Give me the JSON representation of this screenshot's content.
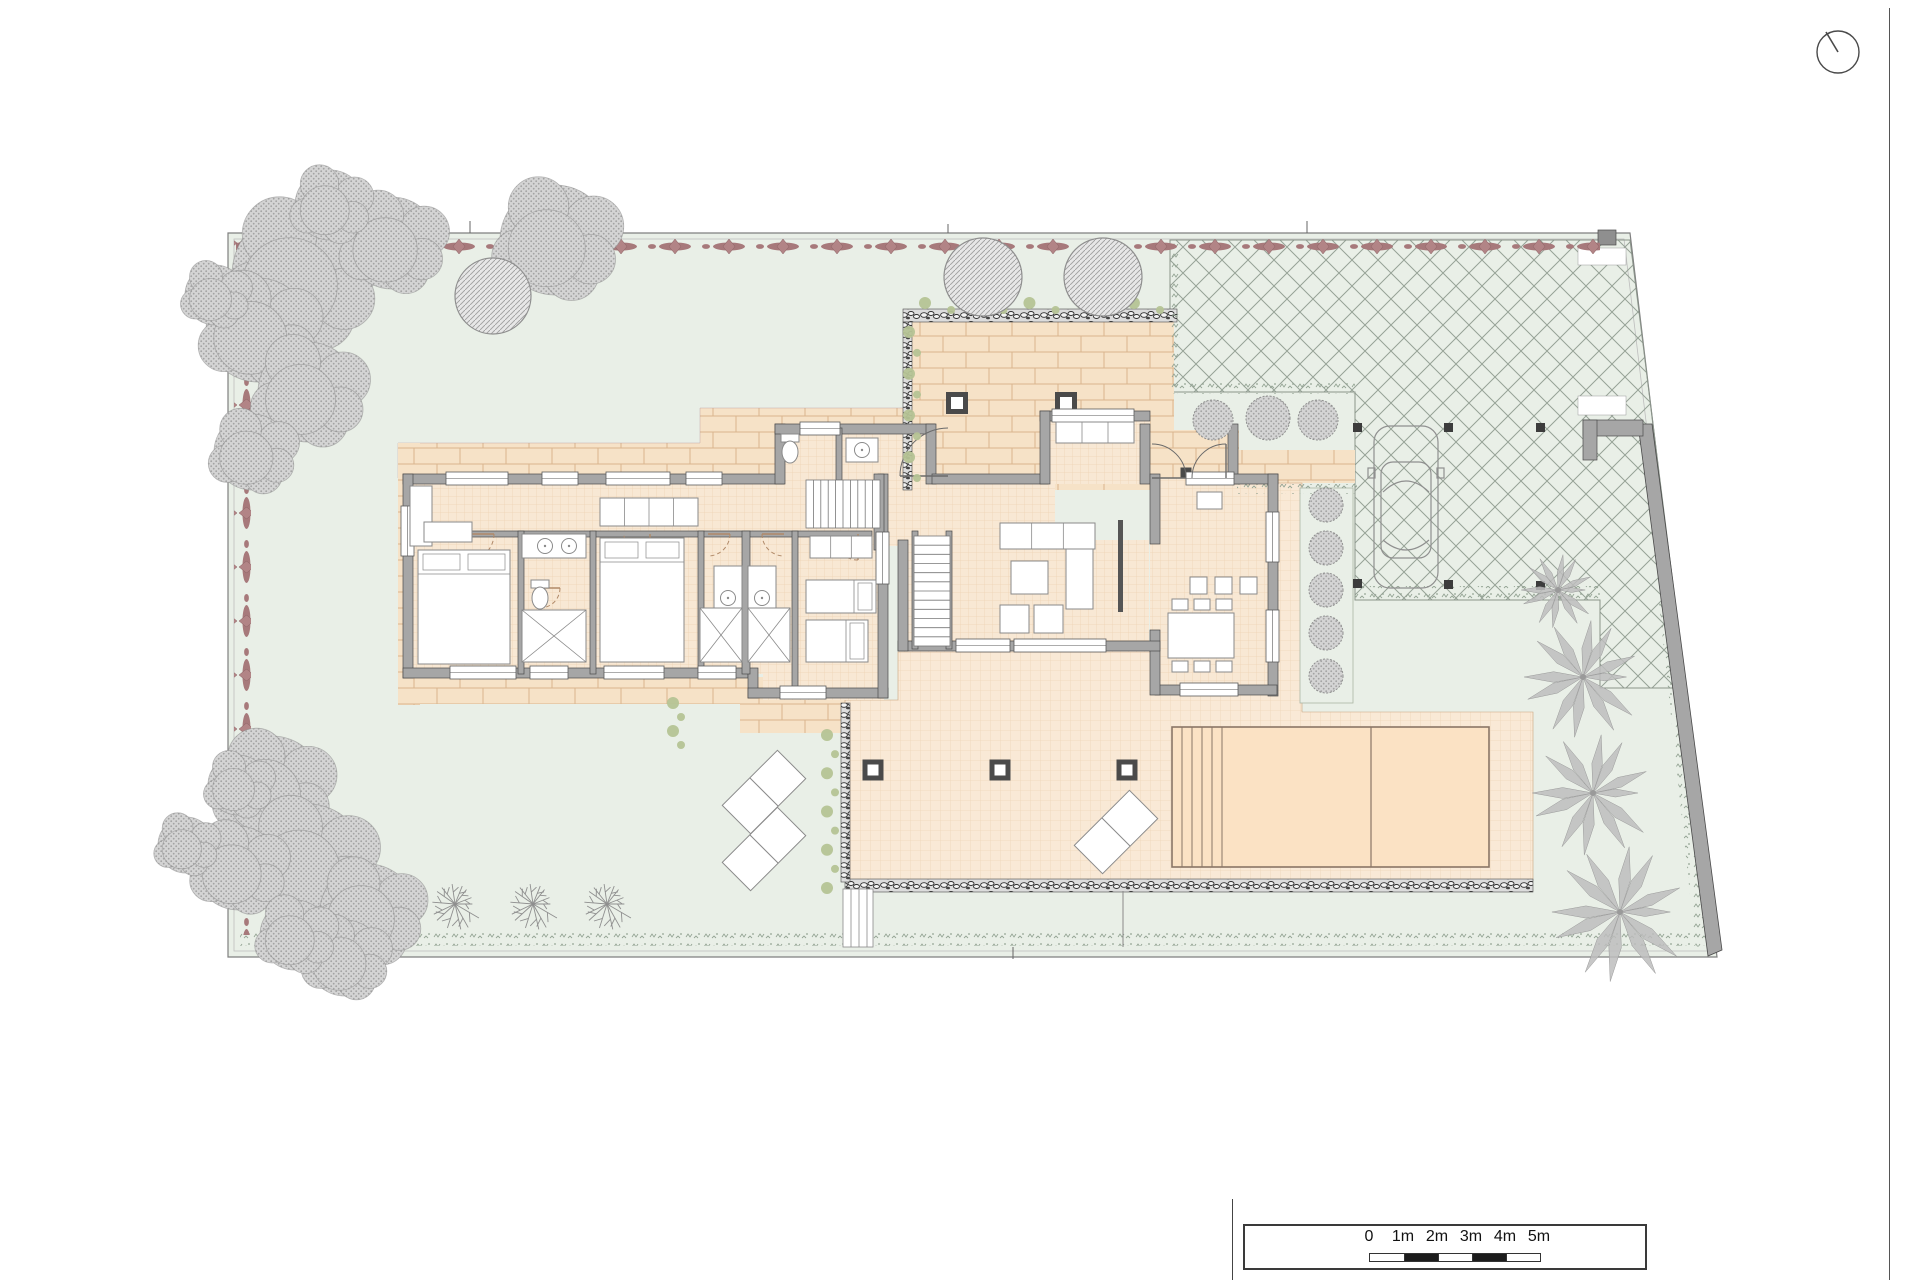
{
  "page": {
    "width": 1920,
    "height": 1280,
    "bg": "#ffffff"
  },
  "colors": {
    "garden": "#e9efe7",
    "lot_line": "#7f7f7f",
    "lot_inner": "#bdbdbd",
    "hedge_fill": "#a7797b",
    "hedge_fill2": "#b28486",
    "hedge_stroke": "#8a6163",
    "canopy_bg": "#d4d4d4",
    "canopy_dot": "#a3a3a3",
    "tree_stroke": "#8f8f8f",
    "cross_line": "#96a296",
    "brick_bg": "#f6e2c7",
    "brick_line": "#d9b48e",
    "tile_bg": "#f8e8d4",
    "tile_line": "#d9a977",
    "terrace_bg": "#f9e9d6",
    "pool_fill": "#fbe2c4",
    "pool_line": "#8a7666",
    "wall": "#a6a6a6",
    "wall_dark": "#4a4a4a",
    "window": "#ffffff",
    "speckle": "#93a393",
    "rubble_bg": "#dcdcdc",
    "rubble_stone": "#2f2f2f",
    "olive": "#b5c395",
    "furn_stroke": "#8a8a8a",
    "door": "#6a6a6a",
    "door_dash": "#b08968",
    "slant_wall": "#a6a6a6",
    "post_dark": "#3c3c3c"
  },
  "scale_bar": {
    "labels": [
      "0",
      "1m",
      "2m",
      "3m",
      "4m",
      "5m"
    ],
    "label_centers": [
      124,
      158,
      192,
      226,
      260,
      294
    ],
    "segments": 5
  },
  "north_indicator": {
    "r": 21,
    "cx": 26,
    "cy": 26,
    "needle_x": 14,
    "needle_y": 6
  },
  "lot": {
    "outline": [
      [
        228,
        233
      ],
      [
        1630,
        233
      ],
      [
        1717,
        957
      ],
      [
        228,
        957
      ]
    ],
    "inner": [
      [
        234,
        239
      ],
      [
        1624,
        239
      ],
      [
        1710,
        951
      ],
      [
        234,
        951
      ]
    ],
    "ticks": [
      [
        470,
        221,
        470,
        233
      ],
      [
        948,
        224,
        948,
        233
      ],
      [
        1307,
        221,
        1307,
        233
      ],
      [
        1013,
        947,
        1013,
        959
      ]
    ]
  },
  "hedge_red": {
    "top": [
      236,
      237,
      1364,
      17
    ],
    "left": [
      234,
      240,
      17,
      695
    ]
  },
  "parking": {
    "poly": [
      [
        1170,
        240
      ],
      [
        1630,
        240
      ],
      [
        1686,
        688
      ],
      [
        1600,
        688
      ],
      [
        1600,
        600
      ],
      [
        1355,
        600
      ],
      [
        1355,
        392
      ],
      [
        1170,
        392
      ]
    ],
    "posts": [
      [
        1353,
        423
      ],
      [
        1444,
        423
      ],
      [
        1536,
        423
      ],
      [
        1353,
        579
      ],
      [
        1444,
        580
      ],
      [
        1536,
        581
      ]
    ],
    "post_size": 9,
    "gates": [
      [
        1578,
        248,
        48,
        17
      ],
      [
        1578,
        396,
        48,
        19
      ]
    ],
    "gate_post": [
      1598,
      230,
      18,
      15
    ],
    "corner_wall": [
      [
        1583,
        420,
        60,
        16
      ],
      [
        1583,
        420,
        14,
        40
      ]
    ]
  },
  "boundary_wall": [
    [
      1638,
      424
    ],
    [
      1652,
      424
    ],
    [
      1722,
      950
    ],
    [
      1708,
      956
    ]
  ],
  "car": {
    "x": 1374,
    "y": 426,
    "w": 64,
    "h": 162
  },
  "brick_polys": [
    [
      [
        398,
        443
      ],
      [
        700,
        443
      ],
      [
        700,
        408
      ],
      [
        935,
        408
      ],
      [
        935,
        430
      ],
      [
        775,
        430
      ],
      [
        775,
        478
      ],
      [
        398,
        478
      ]
    ]
  ],
  "brick_rects": [
    [
      398,
      443,
      22,
      262
    ],
    [
      398,
      677,
      344,
      27
    ],
    [
      740,
      677,
      106,
      56
    ],
    [
      908,
      322,
      266,
      168
    ],
    [
      1238,
      450,
      117,
      33
    ],
    [
      1143,
      430,
      96,
      52
    ]
  ],
  "tile_rects": [
    [
      405,
      478,
      478,
      196
    ],
    [
      763,
      663,
      121,
      37
    ],
    [
      775,
      424,
      161,
      60
    ],
    [
      874,
      474,
      181,
      72
    ],
    [
      1040,
      411,
      110,
      73
    ],
    [
      1150,
      478,
      128,
      216
    ],
    [
      898,
      540,
      251,
      112
    ]
  ],
  "terrace_poly": [
    [
      845,
      700
    ],
    [
      898,
      700
    ],
    [
      898,
      652
    ],
    [
      1155,
      652
    ],
    [
      1155,
      694
    ],
    [
      1276,
      694
    ],
    [
      1276,
      483
    ],
    [
      1302,
      483
    ],
    [
      1302,
      712
    ],
    [
      1533,
      712
    ],
    [
      1533,
      880
    ],
    [
      845,
      880
    ]
  ],
  "shrub_bed": [
    1300,
    488,
    53,
    215
  ],
  "pool": {
    "x": 1172,
    "y": 727,
    "w": 317,
    "h": 140,
    "steps": [
      1182,
      1192,
      1202,
      1212,
      1222
    ],
    "divider": 1371
  },
  "columns": [
    [
      873,
      770
    ],
    [
      1000,
      770
    ],
    [
      1127,
      770
    ]
  ],
  "pergola_posts": [
    [
      957,
      403
    ],
    [
      1066,
      403
    ]
  ],
  "porch_post": [
    1186,
    473
  ],
  "loungers": [
    [
      764,
      792
    ],
    [
      764,
      849
    ],
    [
      1116,
      832
    ]
  ],
  "garden_steps": {
    "x": 843,
    "y": 889,
    "w": 30,
    "h": 58,
    "lines": [
      851,
      859,
      867
    ]
  },
  "rubble_strips": [
    [
      845,
      879,
      688,
      13
    ],
    [
      841,
      703,
      9,
      179
    ],
    [
      903,
      309,
      274,
      13
    ],
    [
      903,
      322,
      9,
      168
    ]
  ],
  "speckle_strips": [
    [
      240,
      931,
      1455,
      15
    ],
    [
      1355,
      586,
      248,
      13
    ],
    [
      1173,
      383,
      182,
      11
    ],
    [
      1237,
      484,
      120,
      10
    ],
    [
      1168,
      242,
      12,
      152
    ]
  ],
  "speckle_slope": {
    "x1": 1666,
    "y1": 598,
    "x2": 1703,
    "y2": 946,
    "w": 15
  },
  "olive_runs": [
    {
      "x": 830,
      "y1": 735,
      "y2": 888,
      "n": 9
    },
    {
      "x": 912,
      "y1": 332,
      "y2": 478,
      "n": 8
    },
    {
      "x": 676,
      "y1": 703,
      "y2": 745,
      "n": 4
    },
    {
      "y": 306,
      "x1": 925,
      "x2": 1160,
      "n": 10
    }
  ],
  "misc_lines": [
    [
      1123,
      891,
      1123,
      947
    ]
  ],
  "trees": {
    "canopies": [
      [
        300,
        275,
        68
      ],
      [
        392,
        243,
        46
      ],
      [
        330,
        205,
        35
      ],
      [
        555,
        240,
        55
      ],
      [
        258,
        330,
        52
      ],
      [
        308,
        392,
        50
      ],
      [
        252,
        452,
        38
      ],
      [
        215,
        295,
        30
      ],
      [
        272,
        788,
        52
      ],
      [
        308,
        862,
        58
      ],
      [
        368,
        912,
        48
      ],
      [
        238,
        868,
        42
      ],
      [
        186,
        845,
        28
      ],
      [
        345,
        958,
        38
      ],
      [
        295,
        935,
        35
      ],
      [
        238,
        785,
        30
      ]
    ],
    "circle_trees": [
      [
        493,
        296,
        38
      ],
      [
        983,
        277,
        39
      ],
      [
        1103,
        277,
        39
      ]
    ],
    "radial": [
      [
        455,
        904,
        28
      ],
      [
        533,
        904,
        28
      ],
      [
        607,
        904,
        28
      ]
    ],
    "shrubs": [
      [
        1213,
        420,
        20
      ],
      [
        1268,
        418,
        22
      ],
      [
        1318,
        420,
        20
      ],
      [
        1326,
        505,
        17
      ],
      [
        1326,
        548,
        17
      ],
      [
        1326,
        590,
        17
      ],
      [
        1326,
        633,
        17
      ],
      [
        1326,
        676,
        17
      ]
    ],
    "palms": [
      [
        1583,
        677,
        64
      ],
      [
        1593,
        793,
        66
      ],
      [
        1620,
        912,
        74
      ],
      [
        1558,
        590,
        40
      ]
    ]
  },
  "house": {
    "walls": [
      [
        403,
        474,
        381,
        10
      ],
      [
        403,
        474,
        10,
        204
      ],
      [
        403,
        668,
        345,
        10
      ],
      [
        748,
        668,
        10,
        30
      ],
      [
        748,
        688,
        140,
        10
      ],
      [
        878,
        474,
        10,
        224
      ],
      [
        775,
        424,
        10,
        60
      ],
      [
        775,
        424,
        160,
        10
      ],
      [
        926,
        424,
        10,
        60
      ],
      [
        932,
        474,
        116,
        10
      ],
      [
        1040,
        411,
        110,
        10
      ],
      [
        1040,
        411,
        10,
        73
      ],
      [
        1140,
        424,
        10,
        60
      ],
      [
        1228,
        424,
        10,
        60
      ],
      [
        1228,
        474,
        50,
        10
      ],
      [
        1268,
        474,
        10,
        222
      ],
      [
        1155,
        685,
        122,
        10
      ],
      [
        1150,
        474,
        10,
        70
      ],
      [
        1150,
        630,
        10,
        65
      ],
      [
        898,
        641,
        262,
        10
      ],
      [
        898,
        540,
        10,
        111
      ],
      [
        874,
        474,
        10,
        76
      ],
      [
        412,
        531,
        460,
        6
      ],
      [
        518,
        531,
        6,
        143
      ],
      [
        590,
        531,
        6,
        143
      ],
      [
        698,
        531,
        6,
        143
      ],
      [
        742,
        531,
        8,
        143
      ],
      [
        792,
        531,
        6,
        163
      ],
      [
        836,
        428,
        6,
        52
      ],
      [
        912,
        531,
        6,
        118
      ],
      [
        946,
        531,
        6,
        118
      ]
    ],
    "dark_walls": [
      [
        1118,
        520,
        5,
        92
      ]
    ],
    "windows": [
      [
        446,
        472,
        62,
        13
      ],
      [
        542,
        472,
        36,
        13
      ],
      [
        606,
        472,
        64,
        13
      ],
      [
        686,
        472,
        36,
        13
      ],
      [
        800,
        422,
        40,
        13
      ],
      [
        1052,
        409,
        82,
        13
      ],
      [
        1186,
        472,
        48,
        13
      ],
      [
        450,
        666,
        66,
        13
      ],
      [
        530,
        666,
        38,
        13
      ],
      [
        604,
        666,
        60,
        13
      ],
      [
        698,
        666,
        38,
        13
      ],
      [
        780,
        686,
        46,
        13
      ],
      [
        956,
        639,
        54,
        13
      ],
      [
        1014,
        639,
        92,
        13
      ],
      [
        1180,
        683,
        58,
        13
      ],
      [
        401,
        506,
        13,
        50
      ],
      [
        876,
        532,
        13,
        52
      ],
      [
        1266,
        512,
        13,
        50
      ],
      [
        1266,
        610,
        13,
        52
      ]
    ],
    "doors": [
      [
        1152,
        478,
        1186,
        478,
        1152,
        444,
        0
      ],
      [
        1226,
        478,
        1226,
        444,
        1192,
        478,
        0
      ],
      [
        948,
        476,
        900,
        476,
        948,
        428,
        0
      ],
      [
        468,
        534,
        494,
        534,
        468,
        560,
        1
      ],
      [
        650,
        534,
        650,
        560,
        624,
        534,
        1
      ],
      [
        858,
        534,
        858,
        560,
        832,
        534,
        1
      ],
      [
        708,
        534,
        730,
        534,
        708,
        556,
        1
      ],
      [
        784,
        534,
        762,
        534,
        784,
        556,
        1
      ],
      [
        540,
        588,
        560,
        588,
        540,
        608,
        1
      ]
    ],
    "stairs": [
      {
        "x": 806,
        "y": 480,
        "w": 74,
        "h": 48,
        "dir": "h",
        "n": 10
      },
      {
        "x": 914,
        "y": 536,
        "w": 36,
        "h": 110,
        "dir": "v",
        "n": 12
      }
    ],
    "furniture": [
      [
        "bed",
        418,
        550,
        92,
        114,
        "v"
      ],
      [
        "bed",
        600,
        538,
        84,
        124,
        "v"
      ],
      [
        "bed",
        806,
        580,
        70,
        33,
        "h"
      ],
      [
        "bed",
        806,
        620,
        62,
        42,
        "h"
      ],
      [
        "divbox",
        600,
        498,
        98,
        28,
        4
      ],
      [
        "divbox",
        810,
        536,
        62,
        22,
        3
      ],
      [
        "box",
        410,
        486,
        22,
        60
      ],
      [
        "box",
        424,
        522,
        48,
        20
      ],
      [
        "divbox",
        1000,
        523,
        95,
        26,
        3
      ],
      [
        "box",
        1066,
        549,
        27,
        60
      ],
      [
        "box",
        1000,
        605,
        29,
        28
      ],
      [
        "box",
        1034,
        605,
        29,
        28
      ],
      [
        "box",
        1011,
        561,
        37,
        33
      ],
      [
        "divbox",
        1056,
        422,
        78,
        21,
        3
      ],
      [
        "box",
        1168,
        613,
        66,
        45
      ],
      [
        "box",
        1172,
        599,
        16,
        11
      ],
      [
        "box",
        1194,
        599,
        16,
        11
      ],
      [
        "box",
        1216,
        599,
        16,
        11
      ],
      [
        "box",
        1172,
        661,
        16,
        11
      ],
      [
        "box",
        1194,
        661,
        16,
        11
      ],
      [
        "box",
        1216,
        661,
        16,
        11
      ],
      [
        "box",
        1190,
        577,
        17,
        17
      ],
      [
        "box",
        1215,
        577,
        17,
        17
      ],
      [
        "box",
        1240,
        577,
        17,
        17
      ],
      [
        "box",
        1197,
        492,
        25,
        17
      ],
      [
        "vanity",
        522,
        534,
        64,
        24,
        [
          [
            545,
            546
          ],
          [
            569,
            546
          ]
        ]
      ],
      [
        "vanity",
        714,
        566,
        28,
        64,
        [
          [
            728,
            598
          ]
        ]
      ],
      [
        "vanity",
        748,
        566,
        28,
        64,
        [
          [
            762,
            598
          ]
        ]
      ],
      [
        "vanity",
        846,
        438,
        32,
        24,
        [
          [
            862,
            450
          ]
        ]
      ],
      [
        "toilet",
        790,
        452
      ],
      [
        "toilet",
        540,
        598
      ],
      [
        "xbox",
        522,
        610,
        64,
        52
      ],
      [
        "xbox",
        700,
        608,
        42,
        54
      ],
      [
        "xbox",
        748,
        608,
        42,
        54
      ]
    ]
  }
}
